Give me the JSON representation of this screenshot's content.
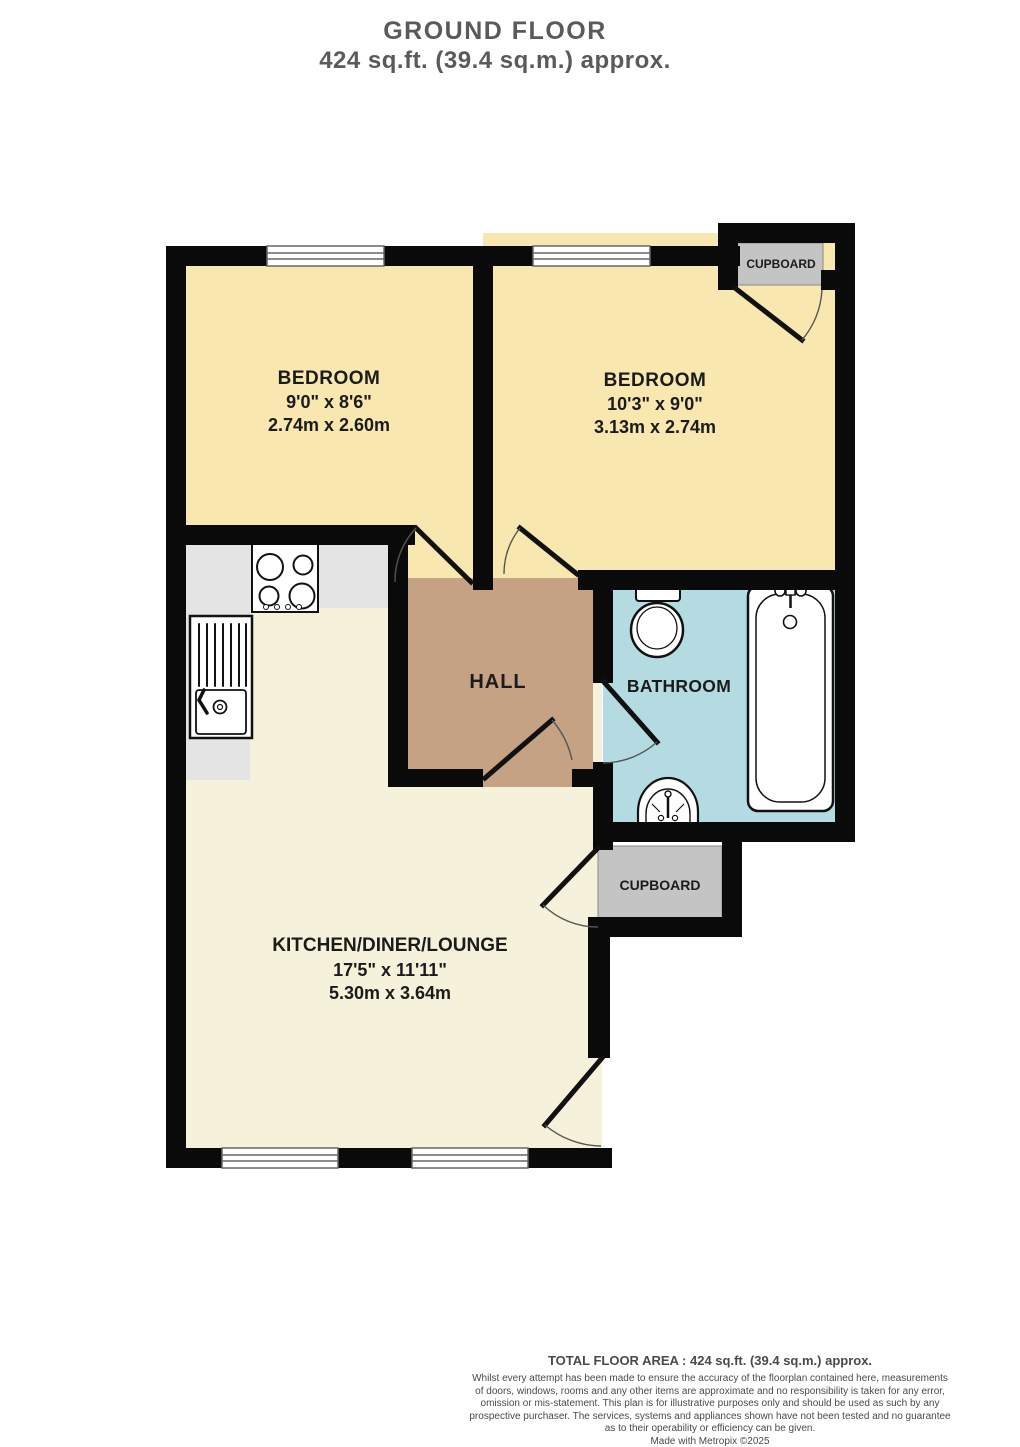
{
  "header": {
    "title": "GROUND FLOOR",
    "subtitle": "424 sq.ft. (39.4 sq.m.) approx."
  },
  "floorplan": {
    "rooms": {
      "bedroom_left": {
        "name": "BEDROOM",
        "dims_imperial": "9'0\" x 8'6\"",
        "dims_metric": "2.74m x 2.60m"
      },
      "bedroom_right": {
        "name": "BEDROOM",
        "dims_imperial": "10'3\" x 9'0\"",
        "dims_metric": "3.13m x 2.74m"
      },
      "hall": {
        "name": "HALL"
      },
      "bathroom": {
        "name": "BATHROOM"
      },
      "kitchen_diner_lounge": {
        "name": "KITCHEN/DINER/LOUNGE",
        "dims_imperial": "17'5\" x 11'11\"",
        "dims_metric": "5.30m x 3.64m"
      },
      "cupboard_top_right": {
        "name": "CUPBOARD"
      },
      "cupboard_middle": {
        "name": "CUPBOARD"
      }
    },
    "fixtures": [
      "stove-hob",
      "kitchen-sink",
      "toilet",
      "wash-basin",
      "bathtub"
    ],
    "colors": {
      "wall": "#0a0a0a",
      "bedroom_fill": "#f8e7af",
      "kitchen_fill": "#f6f1da",
      "hall_fill": "#c5a284",
      "bathroom_fill": "#b5dbe2",
      "cupboard_fill": "#c4c4c4",
      "counter_fill": "#e4e4e4"
    }
  },
  "footer": {
    "total_area": "TOTAL FLOOR AREA : 424 sq.ft. (39.4 sq.m.) approx.",
    "disclaimer_lines": [
      "Whilst every attempt has been made to ensure the accuracy of the floorplan contained here, measurements",
      "of doors, windows, rooms and any other items are approximate and no responsibility is taken for any error,",
      "omission or mis-statement. This plan is for illustrative purposes only and should be used as such by any",
      "prospective purchaser. The services, systems and appliances shown have not been tested and no guarantee",
      "as to their operability or efficiency can be given."
    ],
    "credit": "Made with Metropix ©2025"
  }
}
